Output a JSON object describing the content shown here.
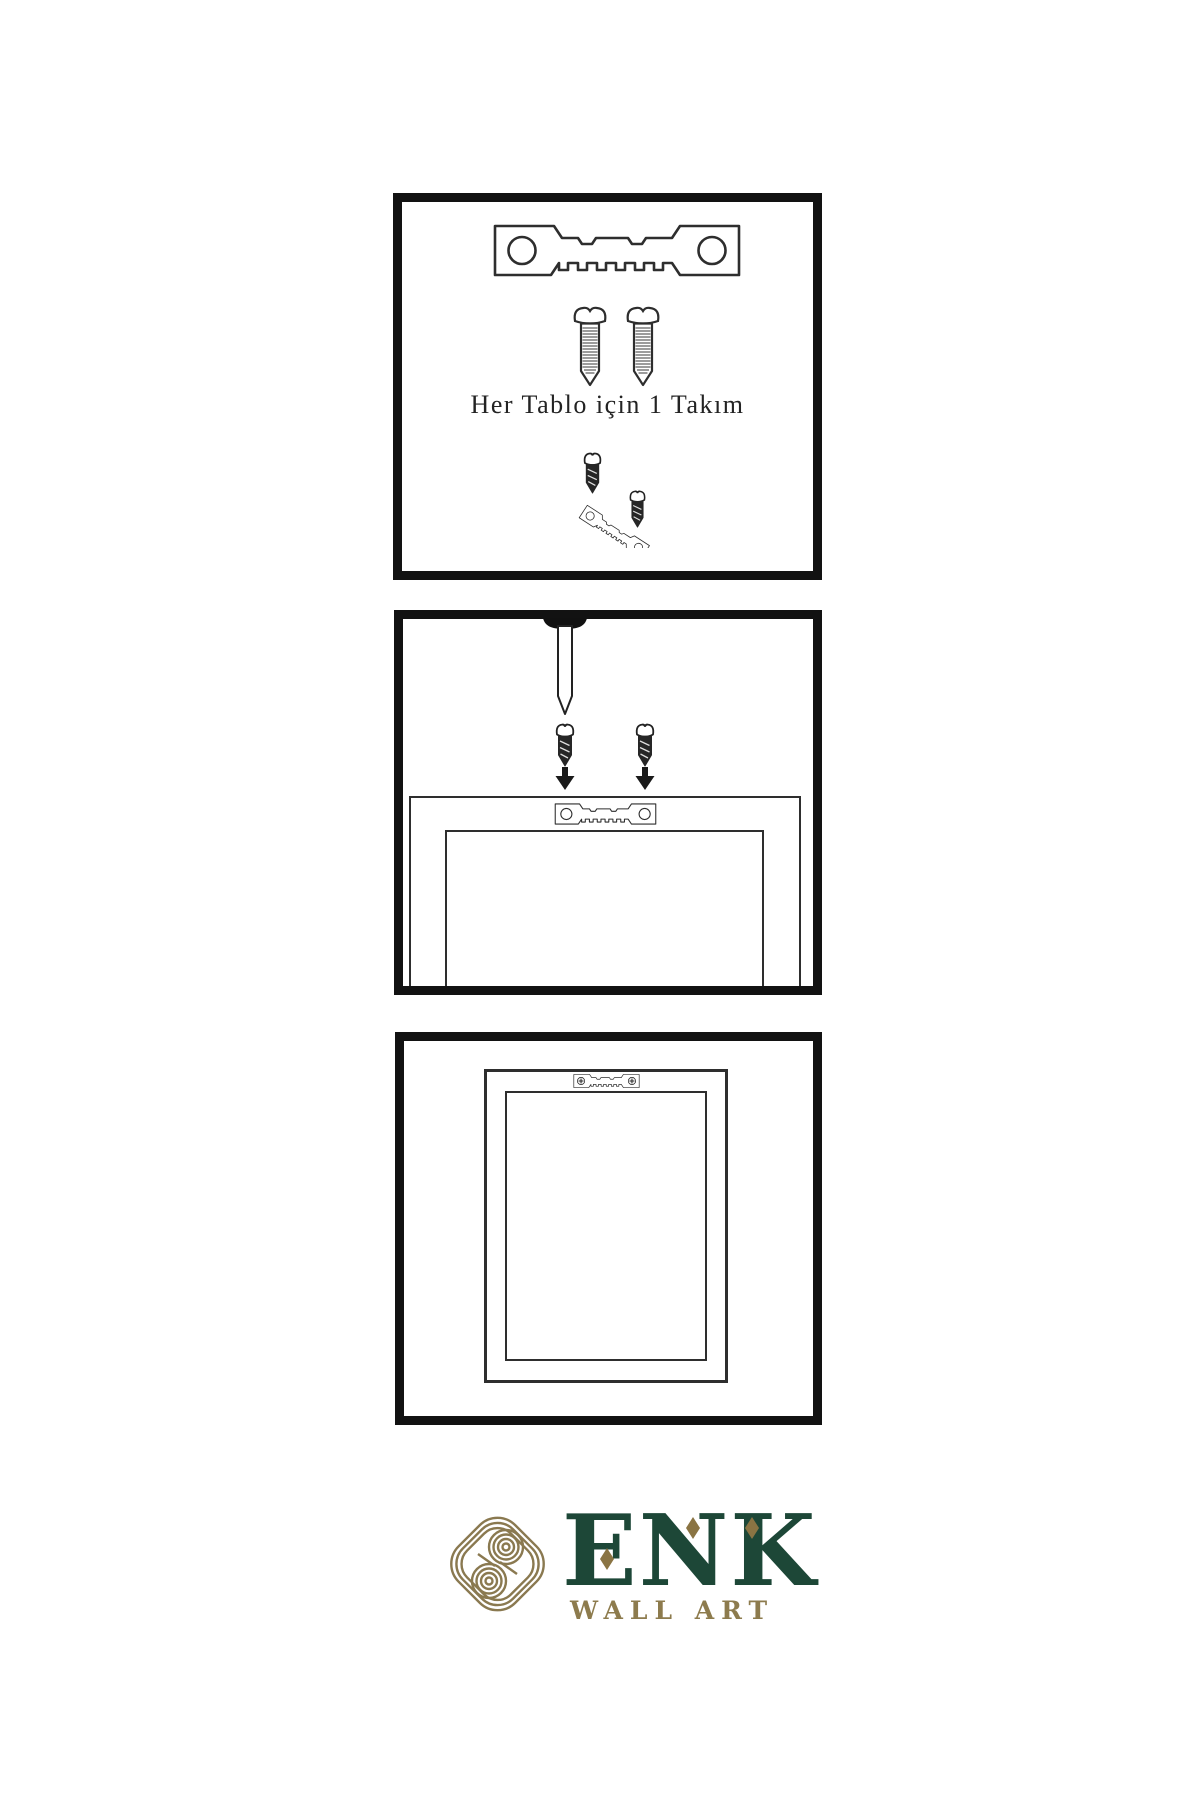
{
  "theme": {
    "bg": "#ffffff",
    "line": "#2e2e2e",
    "panel-border": "#121212",
    "text": "#232323",
    "brand-green": "#1d4737",
    "brand-gold": "#8a7443",
    "brand-gold-light": "#8d7b4d",
    "icon-gold": "#8a7950"
  },
  "steps": {
    "kit": {
      "caption": "Her Tablo için 1 Takım",
      "icons": [
        "sawtooth-hanger-icon",
        "screw-icon",
        "screw-icon",
        "install-demo-icon"
      ]
    },
    "mount": {
      "icons": [
        "nail-icon",
        "dark-screw-icon",
        "dark-screw-icon",
        "arrow-down-icon",
        "arrow-down-icon",
        "sawtooth-hanger-icon",
        "frame-back-illustration"
      ]
    },
    "hang": {
      "icons": [
        "mounted-sawtooth-hanger-icon",
        "hung-frame-illustration"
      ]
    }
  },
  "brand": {
    "name": "ENK",
    "subtitle": "WALL ART",
    "icon": "knot-icon"
  }
}
